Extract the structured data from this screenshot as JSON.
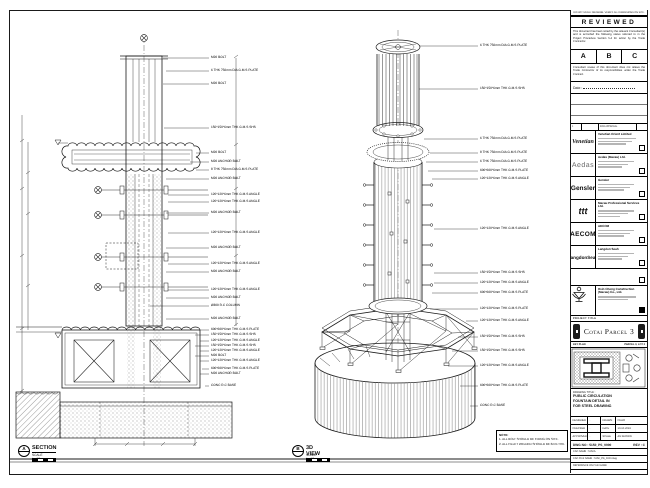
{
  "views": {
    "section": {
      "tag": "A",
      "title": "SECTION",
      "scale": "SCALE 1 : 25",
      "callouts": [
        "M20 BOLT",
        "6 THK 750mm DIA G.M.S PLATE",
        "M20 BOLT",
        "150*150*6mm THK G.M.S SHS",
        "M20 BOLT",
        "M20 ANCHOR BOLT",
        "8 THK 750mm DIA G.M.S PLATE",
        "M20 ANCHOR BOLT",
        "120*120*6mm THK G.M.S ANGLE",
        "120*120*6mm THK G.M.S ANGLE",
        "M20 ANCHOR BOLT",
        "120*120*6mm THK G.M.S ANGLE",
        "M20 ANCHOR BOLT",
        "120*120*6mm THK G.M.S ANGLE",
        "M20 ANCHOR BOLT",
        "120*120*6mm THK G.M.S ANGLE",
        "M20 ANCHOR BOLT",
        "Ø300 R.C COLUMN",
        "M20 ANCHOR BOLT",
        "600*600*6mm THK G.M.S PLATE",
        "150*150*6mm THK G.M.S SHS",
        "120*120*6mm THK G.M.S ANGLE",
        "150*150*6mm THK G.M.S SHS",
        "120*120*6mm THK G.M.S ANGLE",
        "M20 BOLT",
        "120*120*6mm THK G.M.S ANGLE",
        "600*600*6mm THK G.M.S PLATE",
        "M20 ANCHOR BOLT",
        "CONC R.C BASE"
      ]
    },
    "iso": {
      "tag": "B",
      "title": "3D VIEW",
      "scale": "SCALE 1 : 25",
      "callouts": [
        "6 THK 750mm DIA G.M.S PLATE",
        "150*150*6mm THK G.M.S SHS",
        "6 THK 750mm DIA G.M.S PLATE",
        "8 THK 750mm DIA G.M.S PLATE",
        "6 THK 750mm DIA G.M.S PLATE",
        "600*600*6mm THK G.M.S PLATE",
        "120*120*6mm THK G.M.S ANGLE",
        "120*120*6mm THK G.M.S ANGLE",
        "150*150*6mm THK G.M.S SHS",
        "120*120*6mm THK G.M.S ANGLE",
        "600*600*6mm THK G.M.S PLATE",
        "120*120*6mm THK G.M.S PLATE",
        "120*120*6mm THK G.M.S ANGLE",
        "150*150*6mm THK G.M.S SHS",
        "150*150*6mm THK G.M.S SHS",
        "120*120*6mm THK G.M.S ANGLE",
        "600*600*6mm THK G.M.S PLATE",
        "CONC R.C BASE"
      ]
    },
    "note": {
      "title": "NOTE:",
      "line1": "1. ALL BOLT SHOULD BE FIXING ON SITE.",
      "line2": "2. ALL FILLET WELDED SHOULD BE 6mm THK."
    }
  },
  "titleblock": {
    "strip_note": "DO NOT SCALE DRAWING. VERIFY ALL DIMENSIONS ON SITE.",
    "reviewed": {
      "title": "REVIEWED",
      "para1": "This document has been noted by the relevant Consultant(s) and is accorded the following status referred to in the Project Procedure Section 5.4 for action by the Trade Contractor.",
      "statuses": [
        "A",
        "B",
        "C"
      ],
      "para2": "Consultant review of this document does not relieve the Trade Contractor of its responsibilities under the Trade Contract.",
      "date_label": "Date :"
    },
    "revision": {
      "rev": "1",
      "description": "FOR APPROVAL"
    },
    "parties": [
      {
        "logo": "Venetian",
        "name": "Venetian Orient Limited"
      },
      {
        "logo": "Aedas",
        "name": "Aedas (Macau) Ltd."
      },
      {
        "logo": "Gensler",
        "name": "Gensler"
      },
      {
        "logo": "ttt",
        "name": "Macau Professional Services Ltd."
      },
      {
        "logo": "AECOM",
        "name": "AECOM"
      },
      {
        "logo": "LangdonSeah",
        "name": "Langdon Seah"
      }
    ],
    "contractor": {
      "name_line1": "Hsin Chong Construction",
      "name_line2": "(Macau) Co., Ltd."
    },
    "project": {
      "label": "PROJECT TITLE",
      "name": "Cotai Parcel 3"
    },
    "keyplan": {
      "label": "KEY PLAN",
      "right": "PARCEL 3, LOT 2"
    },
    "drawing_title": {
      "label": "DRAWING TITLE :",
      "line1": "PUBLIC CIRCULATION",
      "line2": "FOUNTAIN DETAIL IN",
      "line3": "FOR STEEL DRAWING"
    },
    "fields": {
      "designed_label": "DESIGNED",
      "designed": "-",
      "drawn_label": "DRAWN",
      "drawn": "CHAO",
      "checked_label": "CHECKED",
      "checked": "-",
      "date_label": "DATE",
      "date": "10-10-2019",
      "approved_label": "APPROVED",
      "approved": "-",
      "scale_label": "SCALE",
      "scale": "AS SHOWN"
    },
    "numbers": {
      "dwg": "DWG NO : 5150_PS_0000",
      "rev": "REV : C",
      "cad_name": "CAD NAME : 5150A",
      "cad_file": "CAD FILE NAME : 5150_PS_0000.dwg",
      "reference": "REFERENCE ON FILE NAME"
    }
  }
}
